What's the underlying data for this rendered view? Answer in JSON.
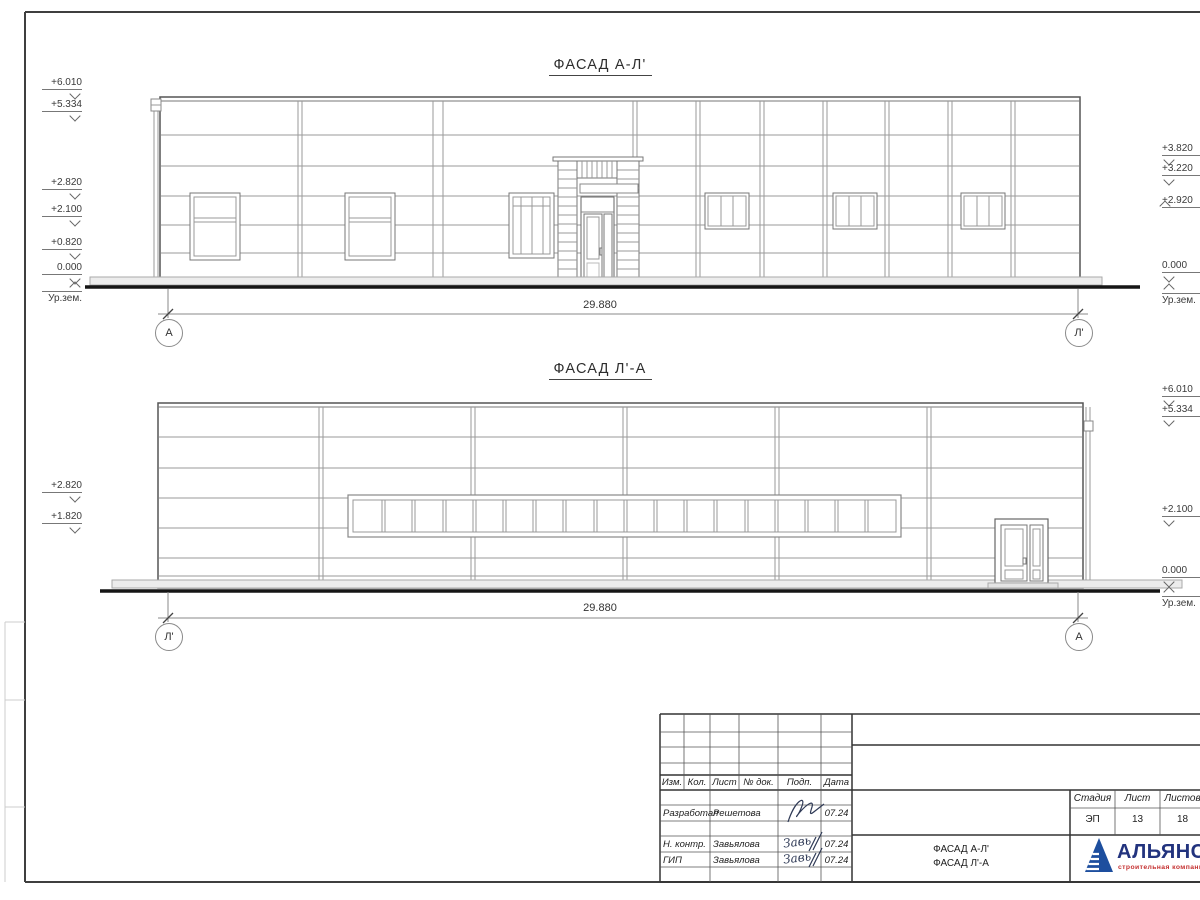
{
  "facade1": {
    "title": "ФАСАД А-Л'",
    "dimension": "29.880",
    "axis_left": "А",
    "axis_right": "Л'",
    "left_marks": [
      "+6.010",
      "+5.334",
      "+2.820",
      "+2.100",
      "+0.820",
      "0.000"
    ],
    "left_ground_label": "Ур.зем.",
    "right_marks": [
      "+3.820",
      "+3.220",
      "+2.920",
      "0.000"
    ],
    "right_ground_label": "Ур.зем."
  },
  "facade2": {
    "title": "ФАСАД Л'-А",
    "dimension": "29.880",
    "axis_left": "Л'",
    "axis_right": "А",
    "left_marks": [
      "+2.820",
      "+1.820"
    ],
    "right_marks": [
      "+6.010",
      "+5.334",
      "+2.100",
      "0.000"
    ],
    "right_ground_label": "Ур.зем."
  },
  "title_block": {
    "revision_headers": [
      "Изм.",
      "Кол.",
      "Лист",
      "№ док.",
      "Подп.",
      "Дата"
    ],
    "rows": [
      {
        "role": "Разработал",
        "name": "Решетова",
        "signature": "",
        "date": "07.24"
      },
      {
        "role": "Н. контр.",
        "name": "Завьялова",
        "signature": "Завь",
        "date": "07.24"
      },
      {
        "role": "ГИП",
        "name": "Завьялова",
        "signature": "Завь",
        "date": "07.24"
      }
    ],
    "drawing_name": {
      "line1": "ФАСАД А-Л'",
      "line2": "ФАСАД Л'-А"
    },
    "stage_label": "Стадия",
    "sheet_label": "Лист",
    "sheets_label": "Листов",
    "stage": "ЭП",
    "sheet": "13",
    "sheets": "18",
    "logo": {
      "name": "АЛЬЯНС",
      "tagline": "строительная компания"
    }
  },
  "colors": {
    "logo_blue": "#1d4e9e",
    "logo_text_blue": "#22337e",
    "logo_red": "#c53030",
    "line_dark": "#333333",
    "line_light": "#9a9a9a"
  }
}
